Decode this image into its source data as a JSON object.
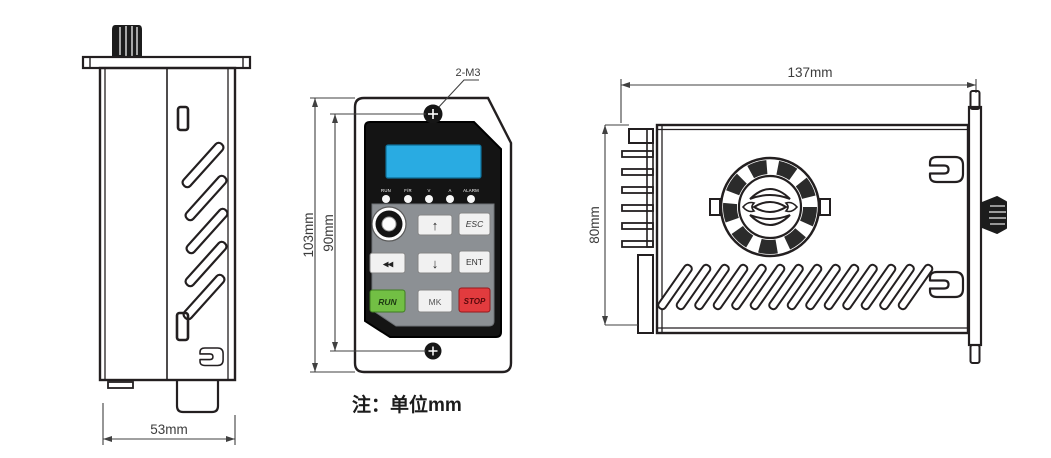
{
  "note": "注：单位mm",
  "side_view": {
    "width_dim": "53mm"
  },
  "front_view": {
    "screw_callout": "2-M3",
    "height_dim_outer": "103mm",
    "height_dim_inner": "90mm",
    "led_labels": [
      "RUN",
      "F/R",
      "V",
      "A",
      "ALARM"
    ],
    "keys": {
      "up": "↑",
      "esc": "ESC",
      "rewind": "◀◀",
      "down": "↓",
      "ent": "ENT",
      "run": "RUN",
      "mk": "MK",
      "stop": "STOP"
    }
  },
  "top_view": {
    "width_dim": "137mm",
    "height_dim": "80mm"
  },
  "colors": {
    "lcd_screen": "#29abe2",
    "run_key_green": "#72bf44",
    "stop_key_red": "#e23b3e",
    "keypad_gray": "#8c9094",
    "line": "#231f20"
  }
}
